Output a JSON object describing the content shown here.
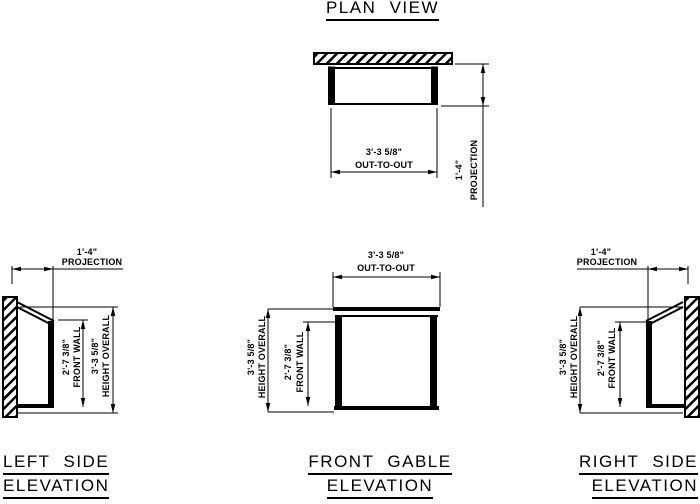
{
  "plan": {
    "title": "PLAN VIEW",
    "out_to_out": {
      "value": "3'-3 5/8\"",
      "label": "OUT-TO-OUT"
    },
    "projection": {
      "value": "1'-4\"",
      "label": "PROJECTION"
    }
  },
  "left": {
    "title1": "LEFT SIDE",
    "title2": "ELEVATION",
    "projection": {
      "value": "1'-4\"",
      "label": "PROJECTION"
    },
    "front_wall": {
      "value": "2'-7 3/8\"",
      "label": "FRONT WALL"
    },
    "height_overall": {
      "value": "3'-3 5/8\"",
      "label": "HEIGHT OVERALL"
    }
  },
  "front": {
    "title1": "FRONT GABLE",
    "title2": "ELEVATION",
    "out_to_out": {
      "value": "3'-3 5/8\"",
      "label": "OUT-TO-OUT"
    },
    "front_wall": {
      "value": "2'-7 3/8\"",
      "label": "FRONT WALL"
    },
    "height_overall": {
      "value": "3'-3 5/8\"",
      "label": "HEIGHT OVERALL"
    }
  },
  "right": {
    "title1": "RIGHT SIDE",
    "title2": "ELEVATION",
    "projection": {
      "value": "1'-4\"",
      "label": "PROJECTION"
    },
    "front_wall": {
      "value": "2'-7 3/8\"",
      "label": "FRONT WALL"
    },
    "height_overall": {
      "value": "3'-3 5/8\"",
      "label": "HEIGHT OVERALL"
    }
  },
  "colors": {
    "line": "#000000",
    "background": "#ffffff"
  }
}
